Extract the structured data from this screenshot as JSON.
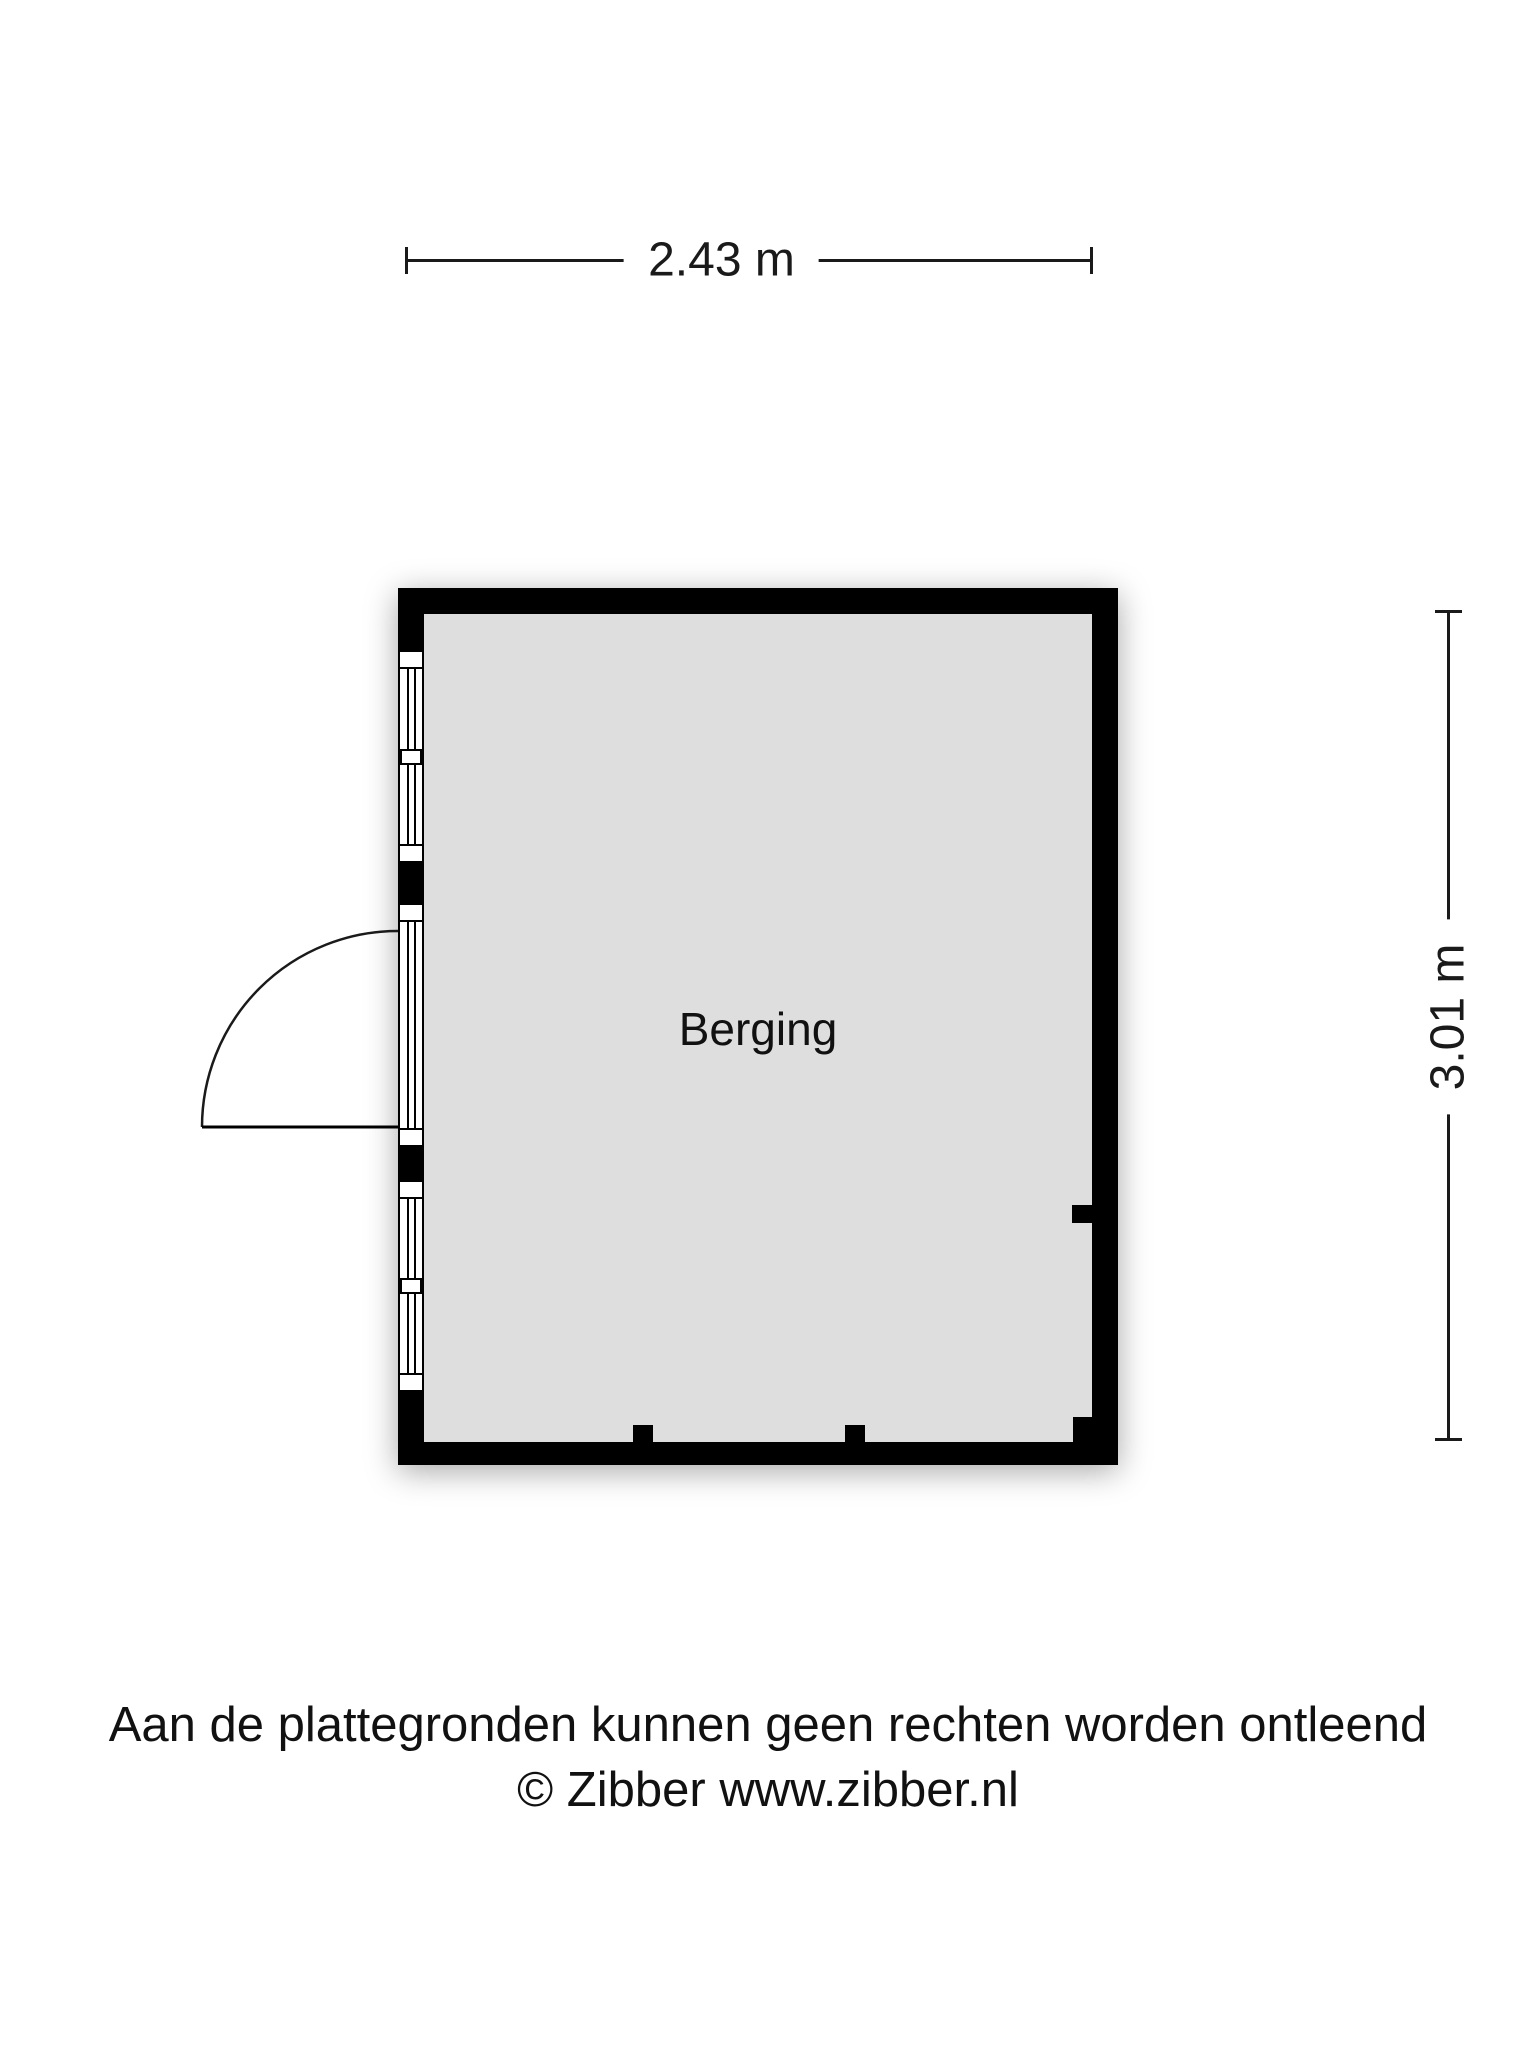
{
  "dimensions": {
    "width_label": "2.43 m",
    "height_label": "3.01 m"
  },
  "room": {
    "label": "Berging"
  },
  "footer": {
    "disclaimer": "Aan de plattegronden kunnen geen rechten worden ontleend",
    "copyright": "© Zibber www.zibber.nl"
  },
  "colors": {
    "wall": "#000000",
    "floor": "#dedede",
    "line": "#1a1a1a",
    "background": "#ffffff"
  }
}
